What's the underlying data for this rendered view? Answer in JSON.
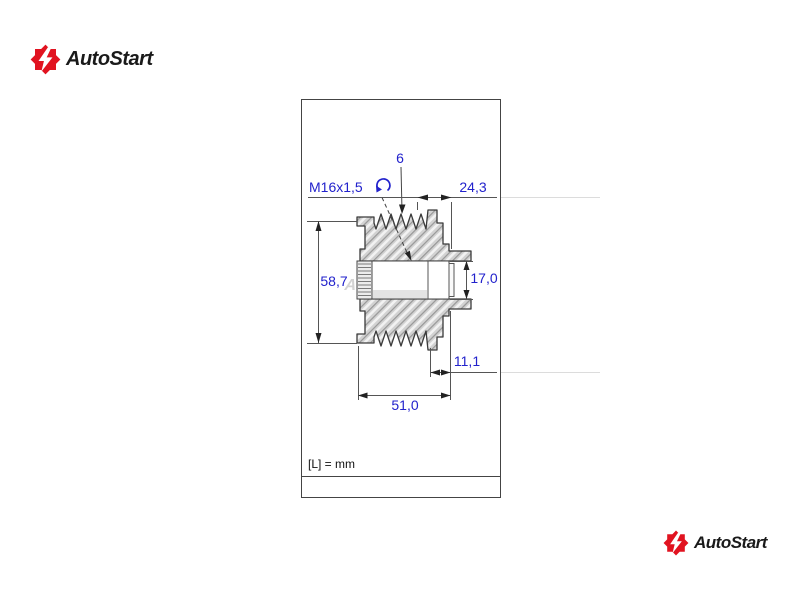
{
  "brand": {
    "name": "AutoStart",
    "accent_color": "#e11320",
    "text_color": "#1a1a1a"
  },
  "drawing": {
    "watermark": "AutoStart",
    "units_note": "[L] = mm",
    "dim_color": "#2222cc",
    "line_color": "#444444",
    "dimensions": {
      "groove_count": "6",
      "thread": "M16x1,5",
      "top_width": "24,3",
      "overall_height": "58,7",
      "bore_height": "17,0",
      "right_offset": "11,1",
      "pulley_width": "51,0"
    }
  }
}
